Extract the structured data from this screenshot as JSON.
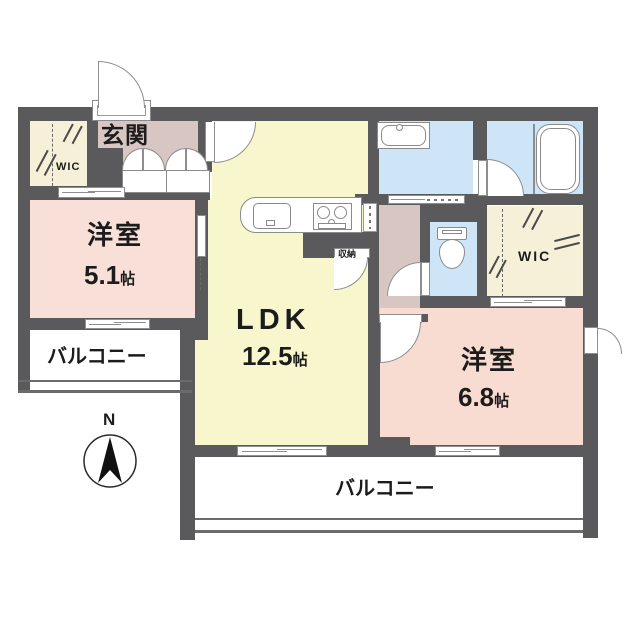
{
  "plan_title": "1LDK+2WIC apartment floor plan",
  "rooms": {
    "genkan": {
      "label": "玄関"
    },
    "wic_left": {
      "label": "WIC"
    },
    "bedroom_small": {
      "label": "洋室",
      "size": "5.1",
      "unit": "帖"
    },
    "ldk": {
      "label": "LDK",
      "size": "12.5",
      "unit": "帖"
    },
    "bedroom_large": {
      "label": "洋室",
      "size": "6.8",
      "unit": "帖"
    },
    "wic_right": {
      "label": "WIC"
    },
    "storage": {
      "label": "収納"
    },
    "balcony_left": {
      "label": "バルコニー"
    },
    "balcony_bottom": {
      "label": "バルコニー"
    }
  },
  "compass": {
    "label": "N"
  },
  "colors": {
    "wall": "#5a595c",
    "ldk_floor": "#f8f6cc",
    "bedroom_small_floor": "#f8dfd8",
    "bedroom_large_floor": "#f8dcd1",
    "entrance_hall_floor": "#d8c6c3",
    "wet_area_floor": "#cde5f6",
    "wic_floor": "#f6f0d8",
    "balcony_floor": "#ffffff",
    "text": "#1c1c1c"
  }
}
